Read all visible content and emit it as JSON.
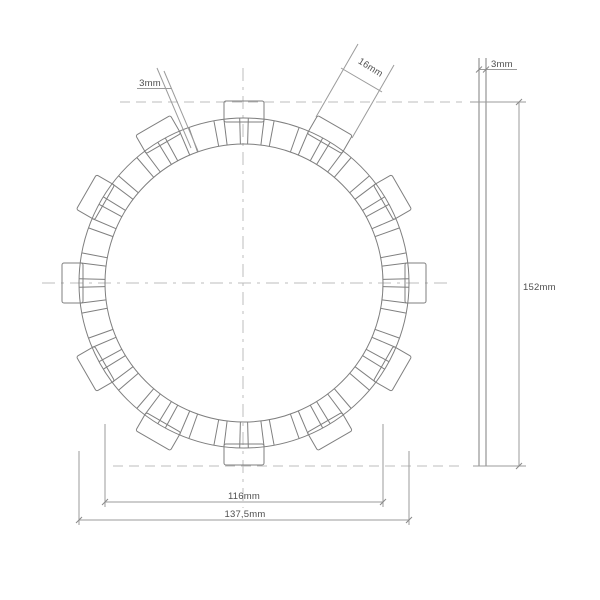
{
  "drawing": {
    "title": "clutch-friction-disc-technical-drawing",
    "views": {
      "front_view": "toothed friction disc, 12 outer tabs",
      "side_view": "plate cross-section"
    },
    "dimensions": {
      "groove_width": "3mm",
      "tab_width": "16mm",
      "thickness": "3mm",
      "overall_diameter": "152mm",
      "friction_inner_diameter": "116mm",
      "friction_outer_diameter": "137,5mm"
    },
    "colors": {
      "background": "#ffffff",
      "outline": "#7f7f7f",
      "dimension_lines": "#9b9b9b",
      "center_lines": "#bcbcbc",
      "text": "#4f4f4f"
    }
  }
}
